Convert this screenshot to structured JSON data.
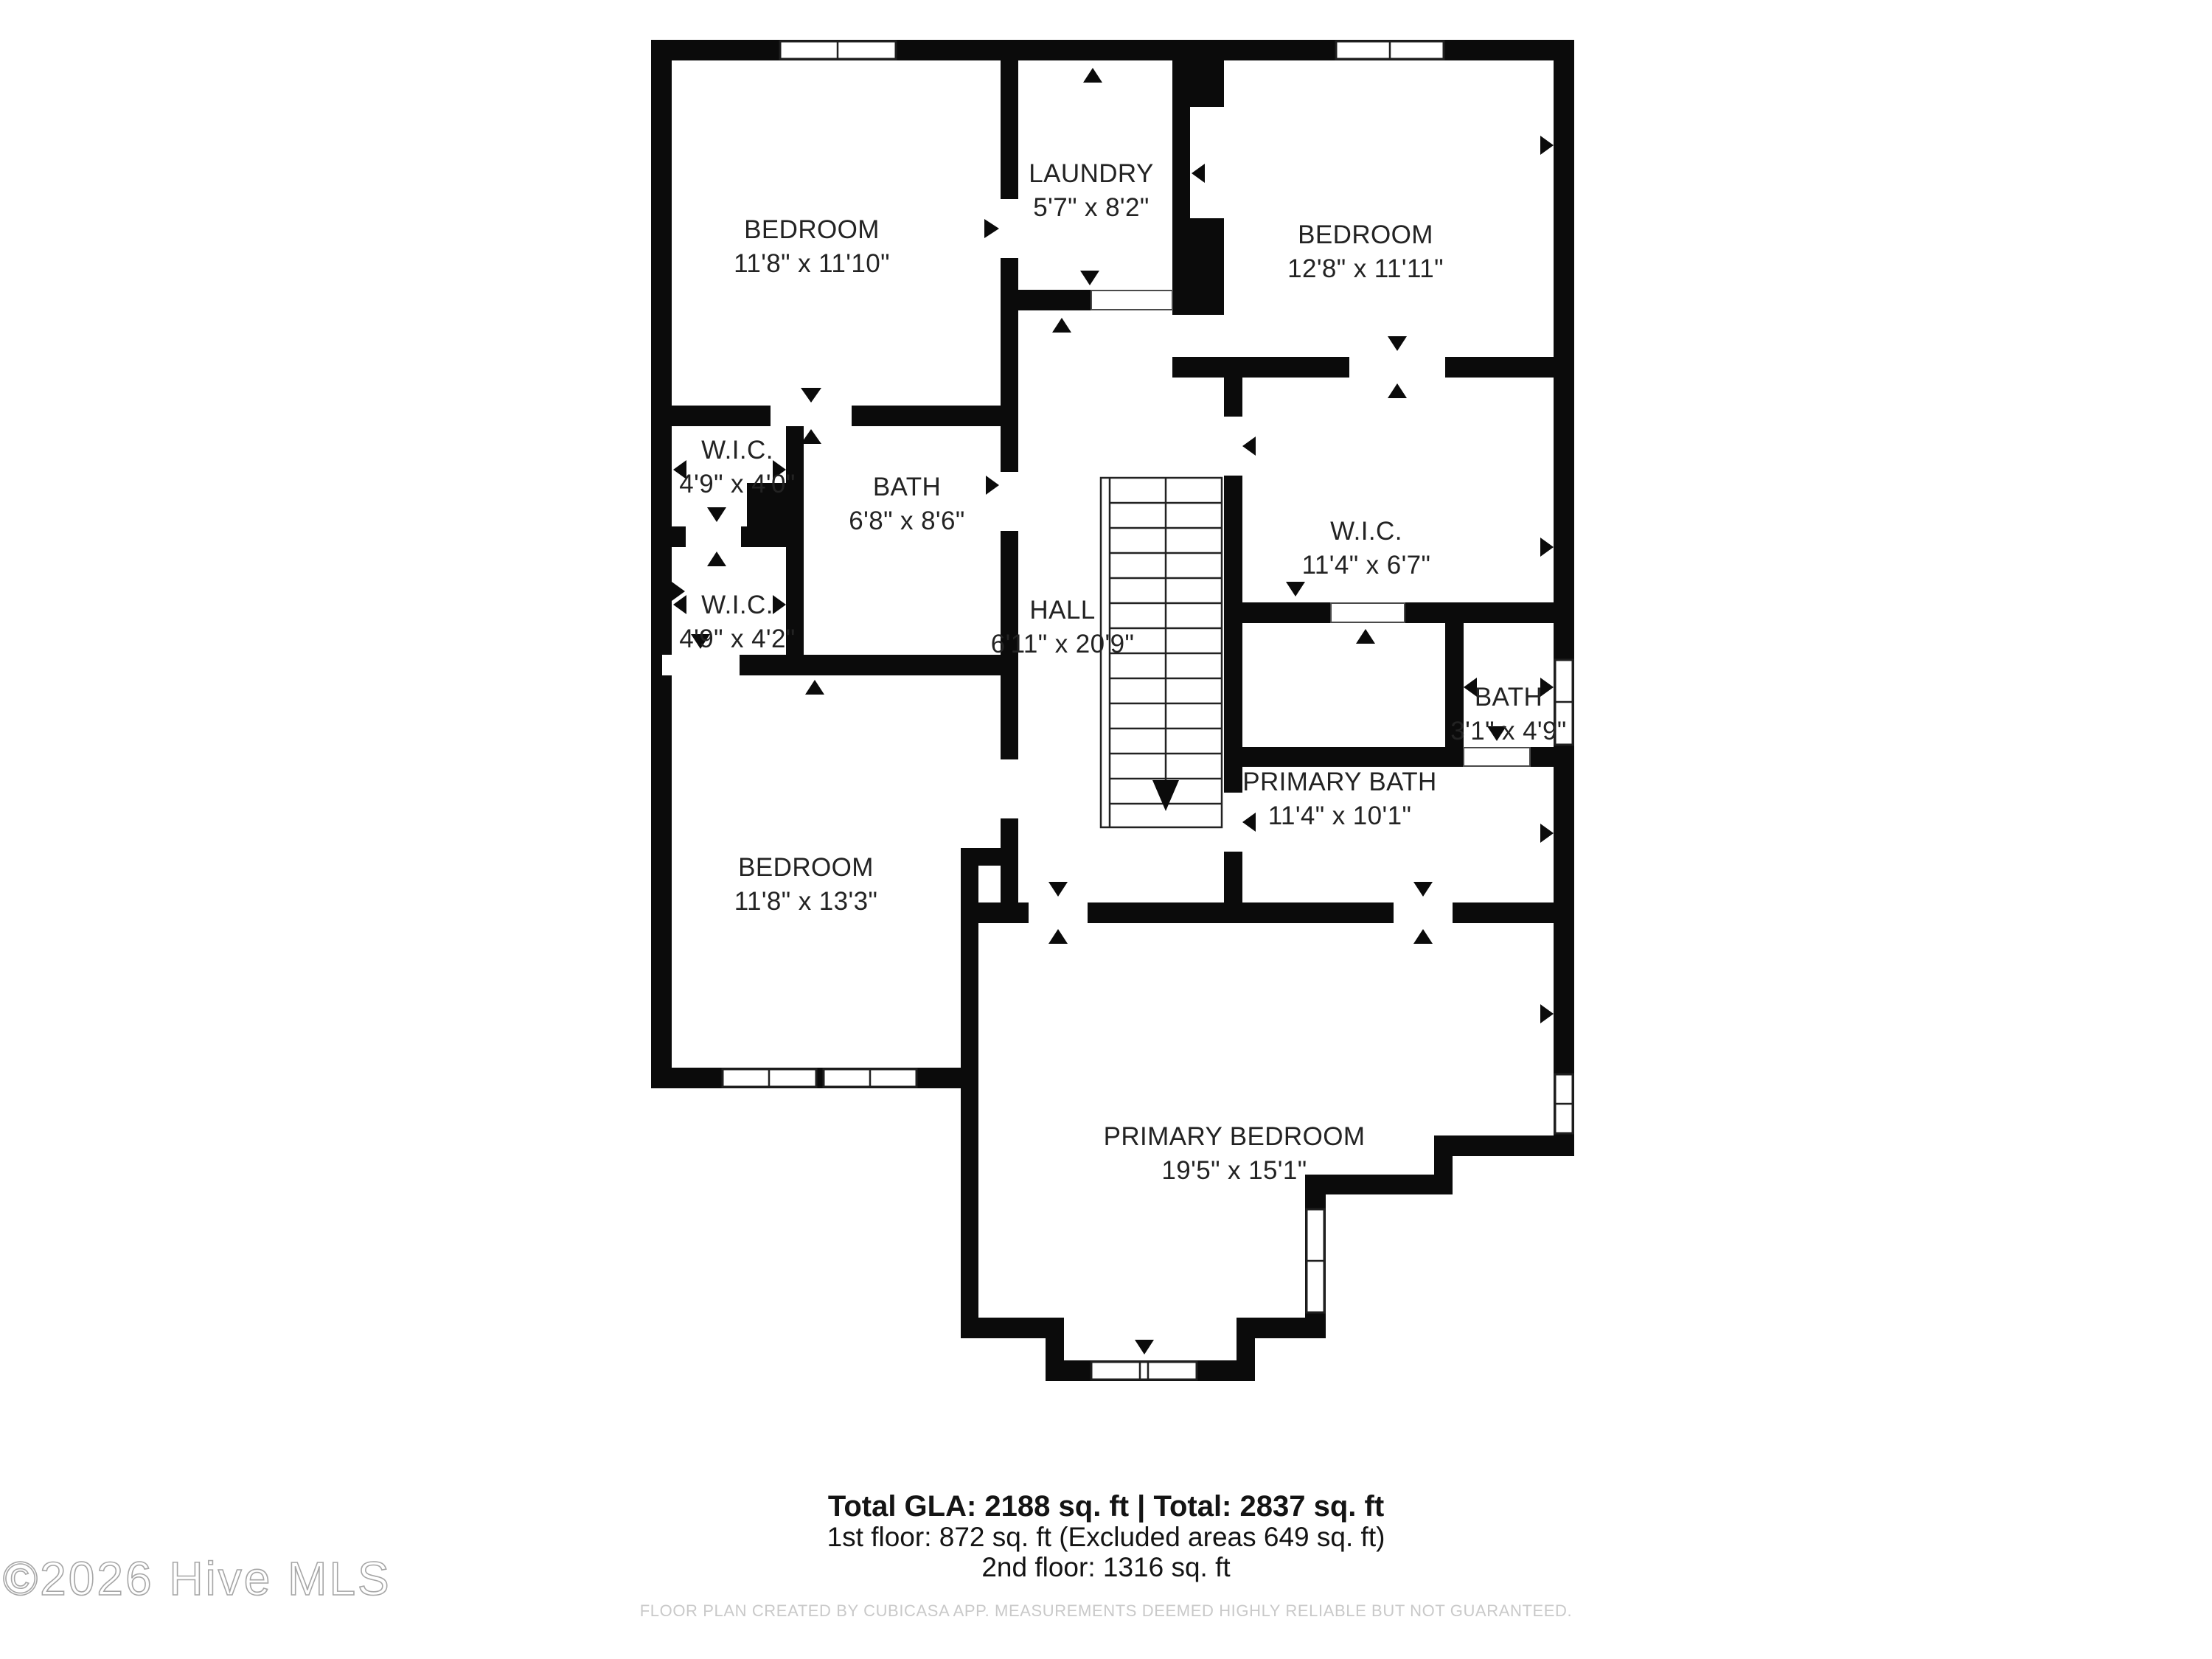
{
  "plan": {
    "rooms": [
      {
        "name": "BEDROOM",
        "dims": "11'8\" x 11'10\""
      },
      {
        "name": "LAUNDRY",
        "dims": "5'7\" x 8'2\""
      },
      {
        "name": "BEDROOM",
        "dims": "12'8\" x 11'11\""
      },
      {
        "name": "W.I.C.",
        "dims": "4'9\" x 4'0\""
      },
      {
        "name": "BATH",
        "dims": "6'8\" x 8'6\""
      },
      {
        "name": "W.I.C.",
        "dims": "11'4\" x 6'7\""
      },
      {
        "name": "W.I.C.",
        "dims": "4'9\" x 4'2\""
      },
      {
        "name": "HALL",
        "dims": "6'11\" x 20'9\""
      },
      {
        "name": "BATH",
        "dims": "3'1\" x 4'9\""
      },
      {
        "name": "PRIMARY BATH",
        "dims": "11'4\" x 10'1\""
      },
      {
        "name": "BEDROOM",
        "dims": "11'8\" x 13'3\""
      },
      {
        "name": "PRIMARY BEDROOM",
        "dims": "19'5\" x 15'1\""
      }
    ]
  },
  "summary": {
    "total_line": "Total GLA: 2188 sq. ft | Total: 2837 sq. ft",
    "first_floor_line": "1st floor: 872 sq. ft (Excluded areas 649 sq. ft)",
    "second_floor_line": "2nd floor: 1316 sq. ft"
  },
  "watermark": "©2026 Hive MLS",
  "disclaimer": "FLOOR PLAN CREATED BY CUBICASA APP. MEASUREMENTS DEEMED HIGHLY RELIABLE BUT NOT GUARANTEED."
}
